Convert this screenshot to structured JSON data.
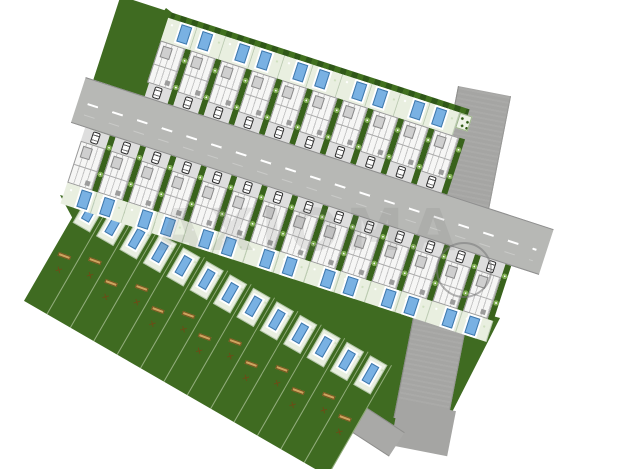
{
  "site": {
    "watermark": "AXIOMA",
    "house_rows": [
      {
        "id": "row-1",
        "houses": 10,
        "pools": 10,
        "driveways": "facing-boulevard-south-side",
        "flower_bed": true
      },
      {
        "id": "row-2",
        "houses": 14,
        "pools": 14,
        "driveways": "facing-boulevard-north-side",
        "flower_bed": false
      }
    ],
    "garden_plots": {
      "count": 13,
      "features": [
        "patio",
        "swimming-pool",
        "log",
        "x-mark"
      ],
      "x_mark_glyph": "✕"
    },
    "roads": {
      "main_boulevard": {
        "marking": "white-dashed-center-line",
        "color": "#b7b8b5"
      },
      "east_road": {
        "color": "#a5a5a3"
      },
      "south_road": {
        "color": "#a9a9a7"
      }
    },
    "roundabout": {
      "present": true
    },
    "colors": {
      "lawn_green": "#3f6b21",
      "hedge_green_dark": "#2f5718",
      "patio_pale": "#e9efe0",
      "pool_blue": "#79b1e3",
      "pool_edge": "#3f79ad",
      "house_white": "#f6f6f5",
      "roof_line_gray": "#9a9a9a",
      "driveway_gray": "#dedede",
      "log_tan": "#cda45f",
      "background": "#ffffff"
    }
  }
}
